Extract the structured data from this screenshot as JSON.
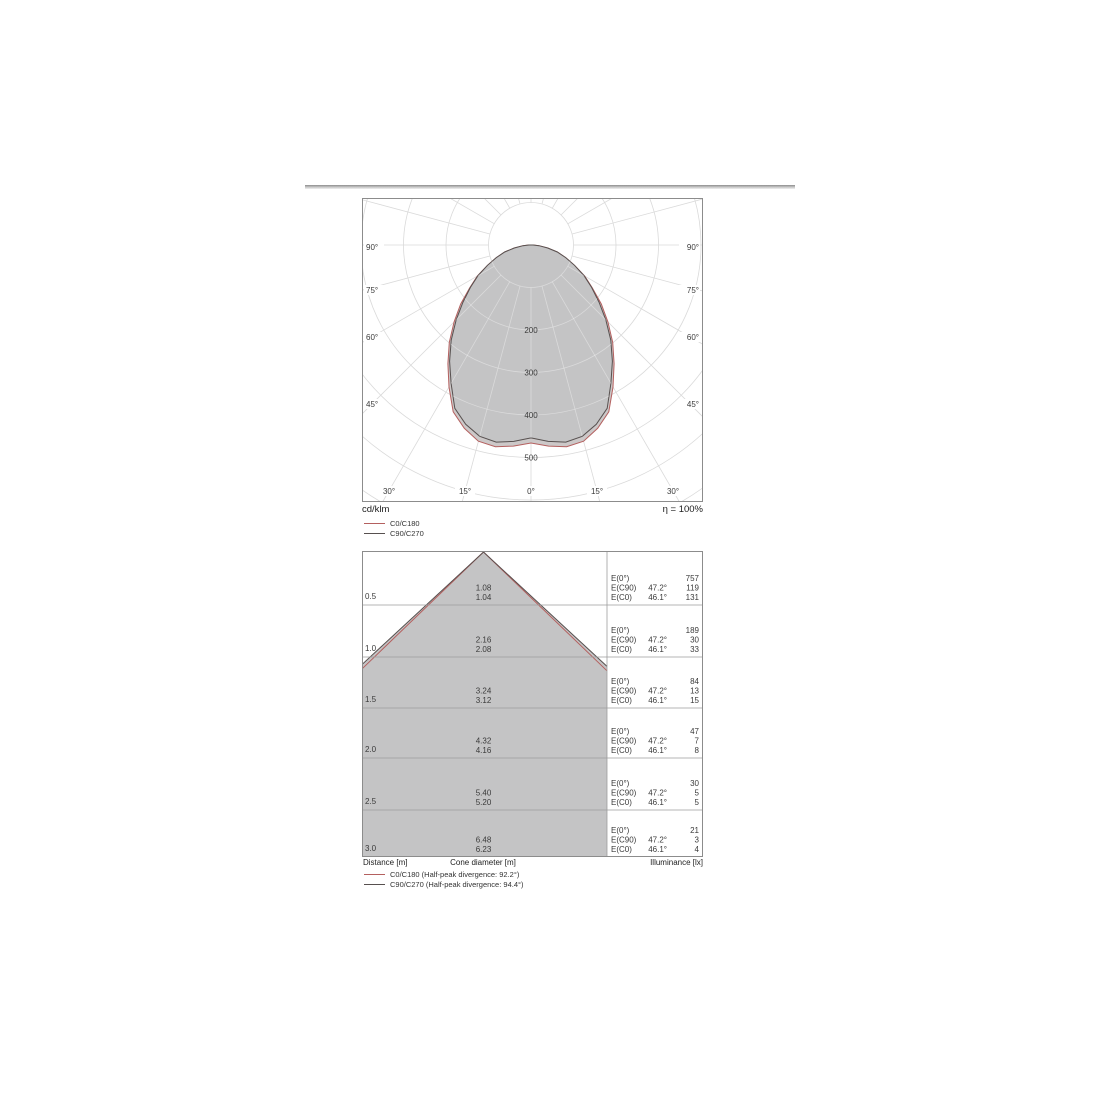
{
  "polar": {
    "unit": "cd/klm",
    "eta": "η = 100%",
    "side_angle_labels": [
      "90°",
      "75°",
      "60°",
      "45°"
    ],
    "bottom_angle_labels": [
      "30°",
      "15°",
      "0°",
      "15°",
      "30°"
    ],
    "ring_labels": [
      "200",
      "300",
      "400",
      "500"
    ],
    "legend": [
      {
        "label": "C0/C180",
        "color": "#b4605f"
      },
      {
        "label": "C90/C270",
        "color": "#57504f"
      }
    ]
  },
  "cone": {
    "e_labels": [
      "E(0°)",
      "E(C90)",
      "E(C0)"
    ],
    "angle_c90": "47.2°",
    "angle_c0": "46.1°",
    "footer": {
      "distance": "Distance [m]",
      "cone_diameter": "Cone diameter [m]",
      "illuminance": "Illuminance [lx]"
    },
    "legend": [
      {
        "label": "C0/C180 (Half-peak divergence: 92.2°)",
        "color": "#b4605f"
      },
      {
        "label": "C90/C270 (Half-peak divergence: 94.4°)",
        "color": "#57504f"
      }
    ]
  },
  "chart_data": [
    {
      "type": "polar-intensity",
      "title": "Polar luminous intensity distribution",
      "unit": "cd/klm",
      "efficiency_percent": 100,
      "ring_step": 100,
      "ring_labeled_max": 500,
      "angles_deg": [
        0,
        5,
        10,
        15,
        20,
        25,
        30,
        35,
        40,
        45,
        50,
        55,
        60,
        65,
        70,
        75,
        80,
        85,
        90
      ],
      "series": [
        {
          "name": "C0/C180",
          "color": "#b4605f",
          "values": [
            466,
            475,
            482,
            478,
            459,
            433,
            386,
            341,
            299,
            256,
            216,
            176,
            146,
            113,
            87,
            64,
            40,
            19,
            5
          ]
        },
        {
          "name": "C90/C270",
          "color": "#57504f",
          "values": [
            454,
            464,
            471,
            466,
            449,
            424,
            376,
            334,
            292,
            249,
            209,
            174,
            144,
            113,
            87,
            64,
            40,
            19,
            5
          ]
        }
      ]
    },
    {
      "type": "cone-diagram",
      "half_angle_c90_deg": 47.2,
      "half_angle_c0_deg": 46.1,
      "half_peak_divergence_c0_deg": 92.2,
      "half_peak_divergence_c90_deg": 94.4,
      "rows": [
        {
          "distance": "0.5",
          "diam_c90": "1.08",
          "diam_c0": "1.04",
          "e0": "757",
          "ec90": "119",
          "ec0": "131"
        },
        {
          "distance": "1.0",
          "diam_c90": "2.16",
          "diam_c0": "2.08",
          "e0": "189",
          "ec90": "30",
          "ec0": "33"
        },
        {
          "distance": "1.5",
          "diam_c90": "3.24",
          "diam_c0": "3.12",
          "e0": "84",
          "ec90": "13",
          "ec0": "15"
        },
        {
          "distance": "2.0",
          "diam_c90": "4.32",
          "diam_c0": "4.16",
          "e0": "47",
          "ec90": "7",
          "ec0": "8"
        },
        {
          "distance": "2.5",
          "diam_c90": "5.40",
          "diam_c0": "5.20",
          "e0": "30",
          "ec90": "5",
          "ec0": "5"
        },
        {
          "distance": "3.0",
          "diam_c90": "6.48",
          "diam_c0": "6.23",
          "e0": "21",
          "ec90": "3",
          "ec0": "4"
        }
      ]
    }
  ]
}
